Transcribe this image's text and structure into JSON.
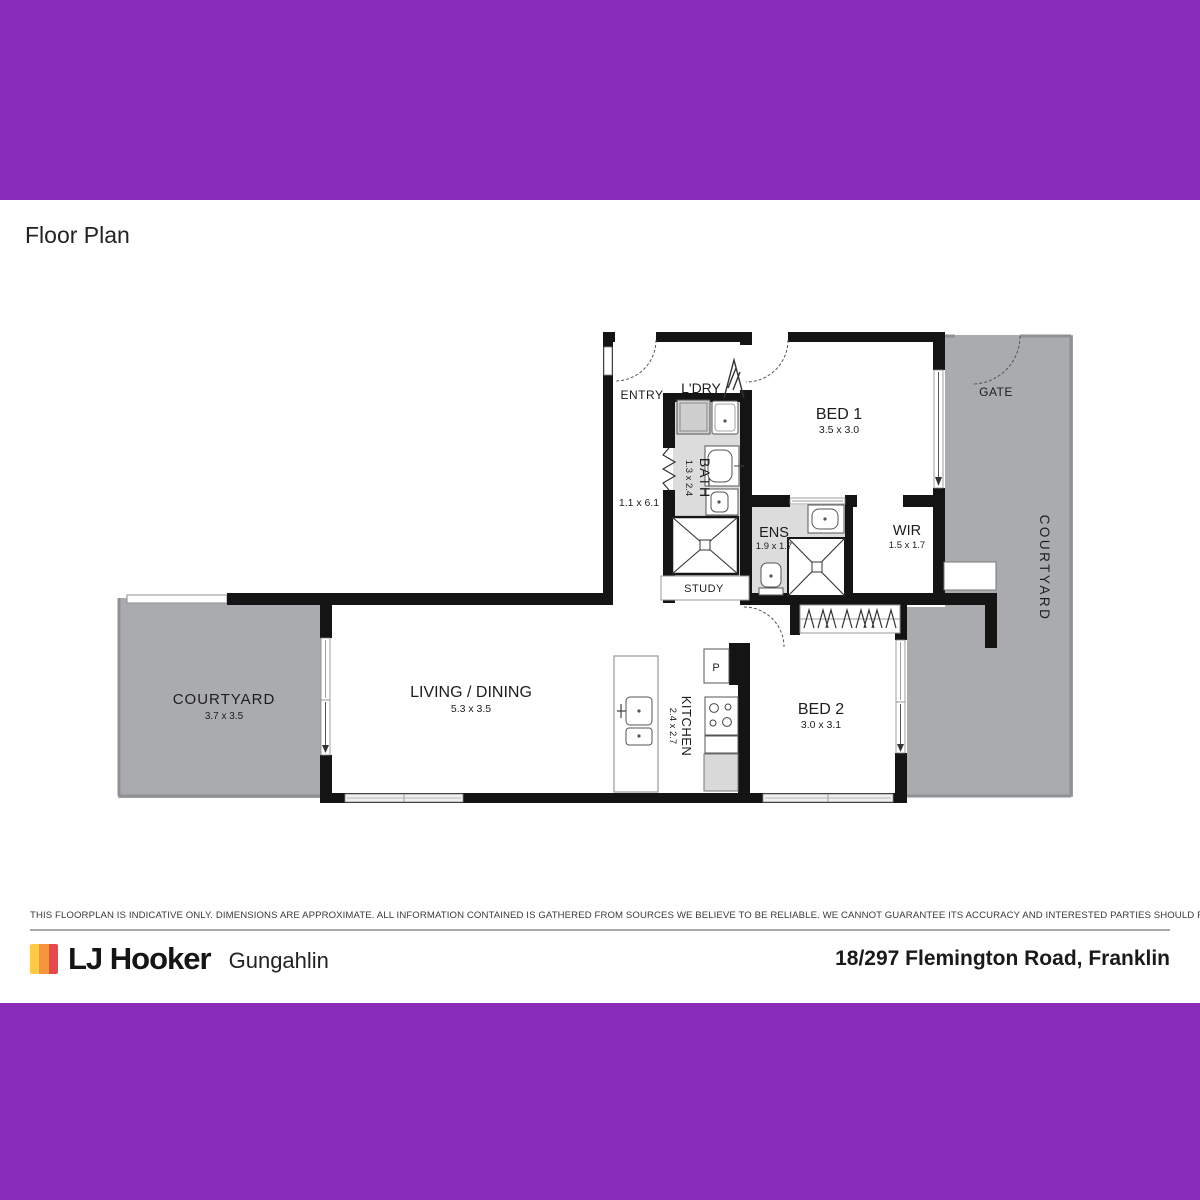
{
  "header": {
    "title": "Floor Plan"
  },
  "plan": {
    "rooms": {
      "bed1": {
        "name": "BED 1",
        "dims": "3.5 x 3.0"
      },
      "bed2": {
        "name": "BED 2",
        "dims": "3.0 x 3.1"
      },
      "living": {
        "name": "LIVING / DINING",
        "dims": "5.3 x 3.5"
      },
      "kitchen": {
        "name": "KITCHEN",
        "dims": "2.4 x 2.7"
      },
      "bath": {
        "name": "BATH",
        "dims": "1.3 x 2.4"
      },
      "ens": {
        "name": "ENS",
        "dims": "1.9 x 1.7"
      },
      "wir": {
        "name": "WIR",
        "dims": "1.5 x 1.7"
      },
      "courtyard_left": {
        "name": "COURTYARD",
        "dims": "3.7 x 3.5"
      },
      "courtyard_right": {
        "name": "COURTYARD"
      },
      "study": {
        "name": "STUDY"
      },
      "laundry": {
        "name": "L'DRY"
      },
      "pantry": {
        "name": "P"
      }
    },
    "labels": {
      "entry": "ENTRY",
      "gate": "GATE",
      "hall_dims": "1.1 x 6.1"
    }
  },
  "disclaimer": "THIS FLOORPLAN IS INDICATIVE ONLY. DIMENSIONS ARE APPROXIMATE. ALL INFORMATION CONTAINED IS GATHERED FROM SOURCES WE BELIEVE TO BE RELIABLE. WE CANNOT GUARANTEE ITS ACCURACY AND INTERESTED PARTIES SHOULD RELY ON THEIR OWN ENQUIRIES.",
  "footer": {
    "brand": "LJ Hooker",
    "office": "Gungahlin",
    "address": "18/297 Flemington Road, Franklin"
  },
  "colors": {
    "banner": "#8A2CBA",
    "courtyard_fill": "#A9ABAE",
    "wet_area_fill": "#DCDCDC",
    "wall": "#141414",
    "logo_stripes": [
      "#FFC845",
      "#F6953D",
      "#E9494C"
    ]
  }
}
